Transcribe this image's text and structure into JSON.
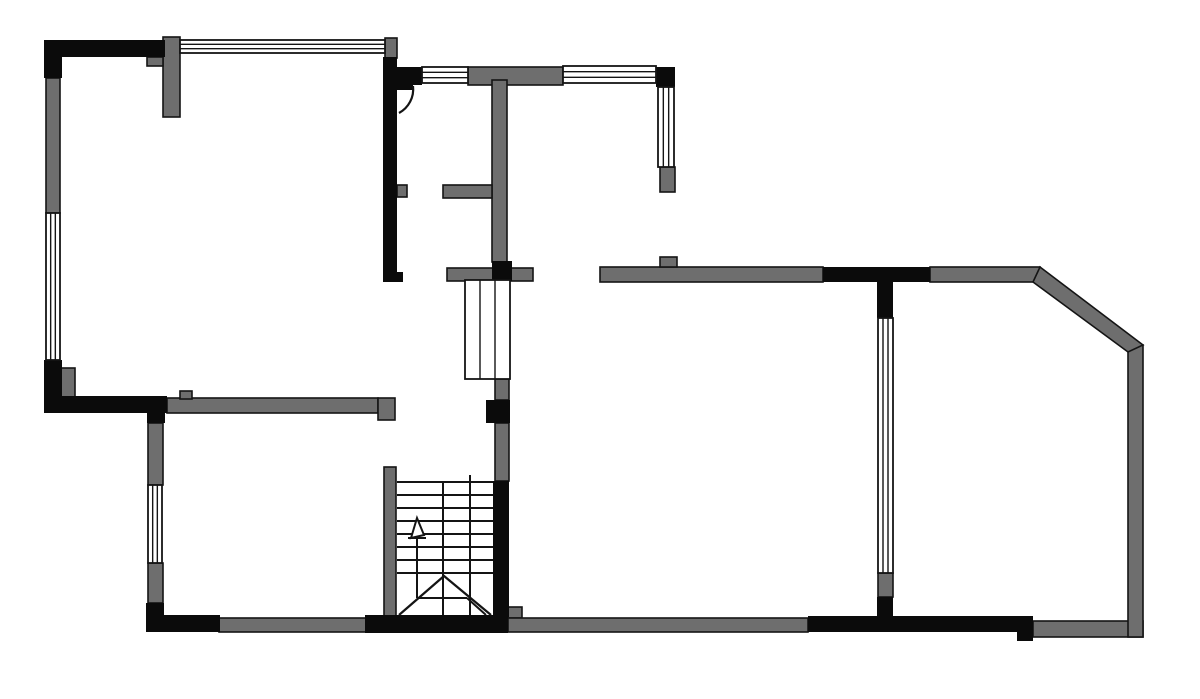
{
  "drawing": {
    "kind": "floor-plan",
    "canvas": {
      "width": 1200,
      "height": 699,
      "background": "#ffffff"
    },
    "palette": {
      "wall_dark": "#0b0b0b",
      "wall_gray": "#6e6e6e",
      "outline": "#141414",
      "window_fill": "#ffffff",
      "line": "#141414"
    },
    "geometry": {
      "black_walls": [
        [
          44,
          40,
          121,
          17
        ],
        [
          44,
          40,
          18,
          38
        ],
        [
          44,
          360,
          18,
          50
        ],
        [
          44,
          396,
          123,
          17
        ],
        [
          147,
          406,
          18,
          17
        ],
        [
          146,
          603,
          18,
          29
        ],
        [
          146,
          615,
          74,
          17
        ],
        [
          365,
          615,
          143,
          18
        ],
        [
          493,
          481,
          16,
          136
        ],
        [
          486,
          400,
          24,
          23
        ],
        [
          383,
          57,
          14,
          225
        ],
        [
          395,
          272,
          8,
          10
        ],
        [
          385,
          67,
          37,
          18
        ],
        [
          656,
          67,
          19,
          20
        ],
        [
          492,
          261,
          20,
          20
        ],
        [
          823,
          267,
          107,
          15
        ],
        [
          877,
          282,
          16,
          36
        ],
        [
          877,
          597,
          16,
          35
        ],
        [
          808,
          616,
          225,
          16
        ],
        [
          1017,
          616,
          16,
          25
        ],
        [
          397,
          81,
          16,
          9
        ]
      ],
      "gray_walls": [
        [
          163,
          37,
          17,
          80
        ],
        [
          147,
          57,
          16,
          9
        ],
        [
          46,
          78,
          14,
          135
        ],
        [
          385,
          38,
          12,
          20
        ],
        [
          60,
          368,
          15,
          29
        ],
        [
          167,
          398,
          211,
          15
        ],
        [
          180,
          391,
          12,
          8
        ],
        [
          378,
          398,
          17,
          22
        ],
        [
          148,
          423,
          15,
          62
        ],
        [
          148,
          563,
          15,
          40
        ],
        [
          219,
          618,
          147,
          14
        ],
        [
          384,
          467,
          12,
          150
        ],
        [
          468,
          67,
          95,
          18
        ],
        [
          492,
          80,
          15,
          182
        ],
        [
          443,
          185,
          49,
          13
        ],
        [
          397,
          185,
          10,
          12
        ],
        [
          660,
          167,
          15,
          25
        ],
        [
          447,
          268,
          86,
          13
        ],
        [
          495,
          379,
          14,
          21
        ],
        [
          495,
          423,
          14,
          58
        ],
        [
          508,
          607,
          14,
          11
        ],
        [
          508,
          618,
          300,
          14
        ],
        [
          600,
          267,
          223,
          15
        ],
        [
          660,
          257,
          17,
          10
        ],
        [
          930,
          267,
          110,
          15
        ],
        [
          878,
          573,
          15,
          24
        ],
        [
          1033,
          621,
          110,
          16
        ],
        [
          1128,
          345,
          15,
          292
        ]
      ],
      "diagonal_wall": "1040,267 1143,345 1128,352 1033,282",
      "windows": [
        {
          "x": 180,
          "y": 40,
          "w": 205,
          "h": 13,
          "o": "h"
        },
        {
          "x": 46,
          "y": 213,
          "w": 14,
          "h": 147,
          "o": "v"
        },
        {
          "x": 422,
          "y": 67,
          "w": 46,
          "h": 16,
          "o": "h"
        },
        {
          "x": 563,
          "y": 66,
          "w": 93,
          "h": 17,
          "o": "h"
        },
        {
          "x": 658,
          "y": 87,
          "w": 16,
          "h": 80,
          "o": "v"
        },
        {
          "x": 148,
          "y": 485,
          "w": 14,
          "h": 78,
          "o": "v"
        },
        {
          "x": 878,
          "y": 318,
          "w": 15,
          "h": 255,
          "o": "v"
        },
        {
          "x": 465,
          "y": 280,
          "w": 45,
          "h": 99,
          "o": "v"
        }
      ],
      "stairs": {
        "tread_x": [
          397,
          493
        ],
        "tread_ys": [
          482,
          495,
          508,
          521,
          534,
          547,
          560,
          573
        ],
        "vertical_lines": [
          [
            443,
            482,
            443,
            615
          ],
          [
            470,
            475,
            470,
            615
          ]
        ],
        "arrow": {
          "stem": [
            417,
            537,
            417,
            598
          ],
          "base": [
            408,
            538,
            426,
            538
          ],
          "head": "411,538 417,518 424,535"
        },
        "break_polyline": "399,615 444,576 491,615",
        "break_lines": [
          [
            417,
            598,
            467,
            598
          ],
          [
            467,
            598,
            486,
            615
          ]
        ]
      },
      "door": {
        "arc": "M 413 86 A 27 27 0 0 1 399 113"
      }
    }
  }
}
